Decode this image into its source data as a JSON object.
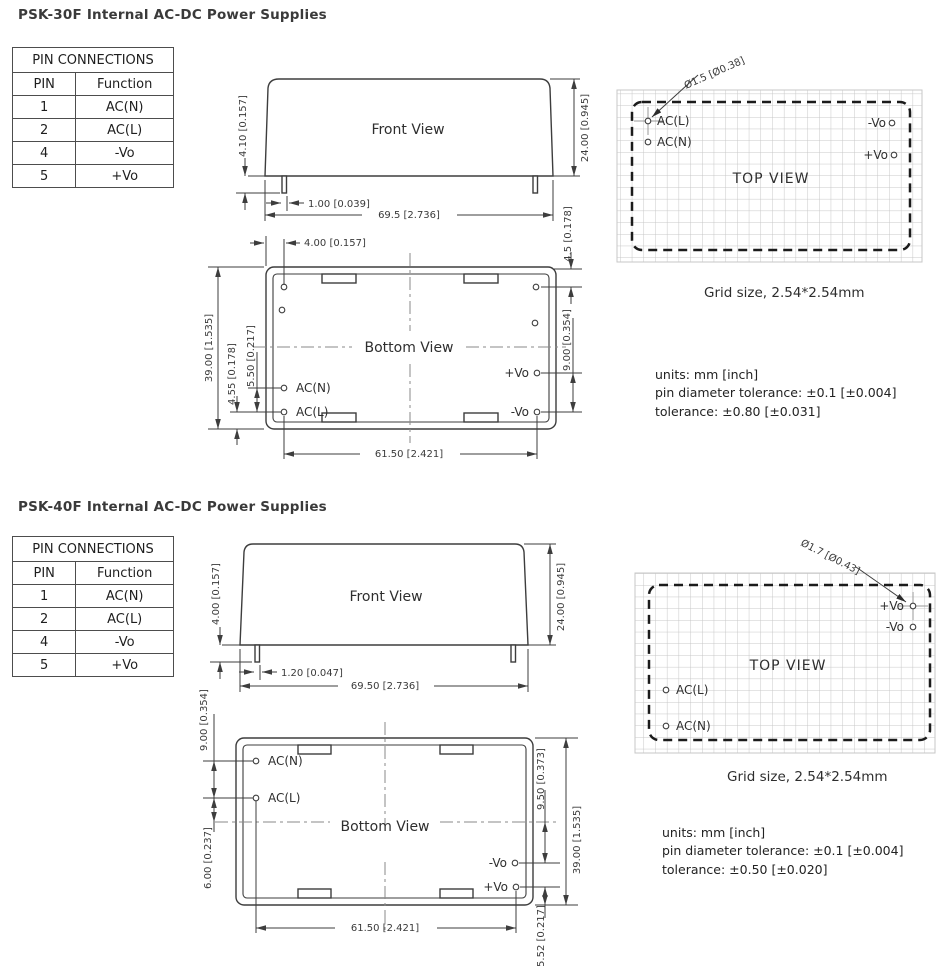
{
  "sections": [
    {
      "id": "psk30f",
      "title": "PSK-30F Internal AC-DC Power Supplies",
      "pin_table": {
        "header": "PIN CONNECTIONS",
        "columns": [
          "PIN",
          "Function"
        ],
        "rows": [
          [
            "1",
            "AC(N)"
          ],
          [
            "2",
            "AC(L)"
          ],
          [
            "4",
            "-Vo"
          ],
          [
            "5",
            "+Vo"
          ]
        ]
      },
      "front_view": {
        "label": "Front View",
        "dim_pin_length": "4.10 [0.157]",
        "dim_height": "24.00 [0.945]",
        "dim_pin_width": "1.00 [0.039]",
        "dim_width": "69.5 [2.736]"
      },
      "bottom_view": {
        "label": "Bottom View",
        "dim_pin_inset": "4.00 [0.157]",
        "dim_top_pin": "4.5 [0.178]",
        "dim_vo_pitch": "9.00 [0.354]",
        "dim_depth": "39.00 [1.535]",
        "dim_ac_pitch": "5.50 [0.217]",
        "dim_acl_edge": "4.55 [0.178]",
        "dim_pin_span": "61.50 [2.421]",
        "pins": {
          "acn": "AC(N)",
          "acl": "AC(L)",
          "pvo": "+Vo",
          "nvo": "-Vo"
        }
      },
      "top_view": {
        "label": "TOP VIEW",
        "pin_diameter": "Ø1.5 [Ø0.38]",
        "pins": {
          "acl": "AC(L)",
          "acn": "AC(N)",
          "nvo": "-Vo",
          "pvo": "+Vo"
        },
        "grid_caption": "Grid size, 2.54*2.54mm"
      },
      "notes": [
        "units: mm [inch]",
        "pin diameter tolerance: ±0.1 [±0.004]",
        "tolerance: ±0.80 [±0.031]"
      ]
    },
    {
      "id": "psk40f",
      "title": "PSK-40F Internal AC-DC Power Supplies",
      "pin_table": {
        "header": "PIN CONNECTIONS",
        "columns": [
          "PIN",
          "Function"
        ],
        "rows": [
          [
            "1",
            "AC(N)"
          ],
          [
            "2",
            "AC(L)"
          ],
          [
            "4",
            "-Vo"
          ],
          [
            "5",
            "+Vo"
          ]
        ]
      },
      "front_view": {
        "label": "Front View",
        "dim_pin_length": "4.00 [0.157]",
        "dim_height": "24.00 [0.945]",
        "dim_pin_width": "1.20 [0.047]",
        "dim_width": "69.50 [2.736]"
      },
      "bottom_view": {
        "label": "Bottom View",
        "dim_ac_pitch": "9.00 [0.354]",
        "dim_acl_center": "6.00 [0.237]",
        "dim_nvo_center": "9.50 [0.373]",
        "dim_depth": "39.00 [1.535]",
        "dim_pvo_edge": "5.52 [0.217]",
        "dim_pin_span": "61.50 [2.421]",
        "pins": {
          "acn": "AC(N)",
          "acl": "AC(L)",
          "pvo": "+Vo",
          "nvo": "-Vo"
        }
      },
      "top_view": {
        "label": "TOP VIEW",
        "pin_diameter": "Ø1.7 [Ø0.43]",
        "pins": {
          "acl": "AC(L)",
          "acn": "AC(N)",
          "nvo": "-Vo",
          "pvo": "+Vo"
        },
        "grid_caption": "Grid size, 2.54*2.54mm"
      },
      "notes": [
        "units: mm [inch]",
        "pin diameter tolerance: ±0.1 [±0.004]",
        "tolerance: ±0.50 [±0.020]"
      ]
    }
  ]
}
